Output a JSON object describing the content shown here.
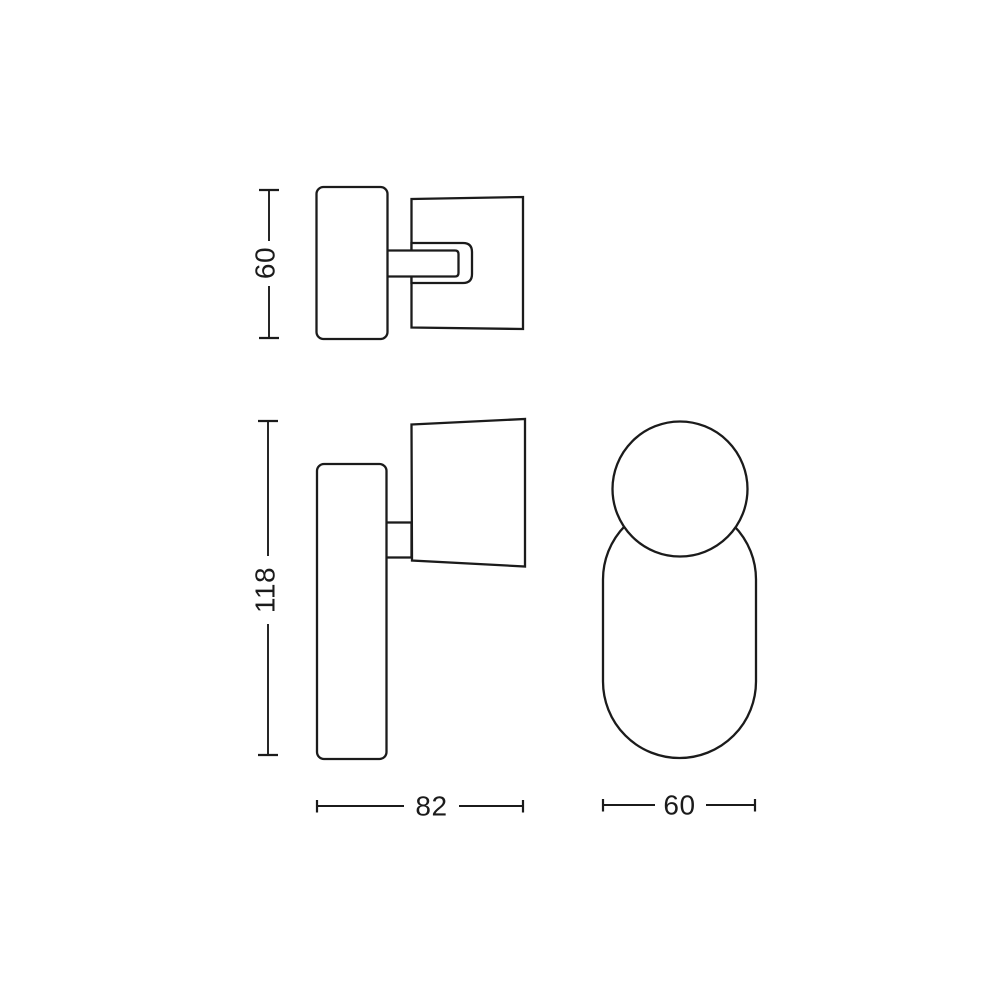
{
  "colors": {
    "background": "#ffffff",
    "line": "#1b1b1b"
  },
  "drawing": {
    "kind": "technical-dimension-drawing"
  },
  "dimensions": {
    "plate_height": "60",
    "total_height": "118",
    "total_width": "82",
    "base_width": "60"
  }
}
